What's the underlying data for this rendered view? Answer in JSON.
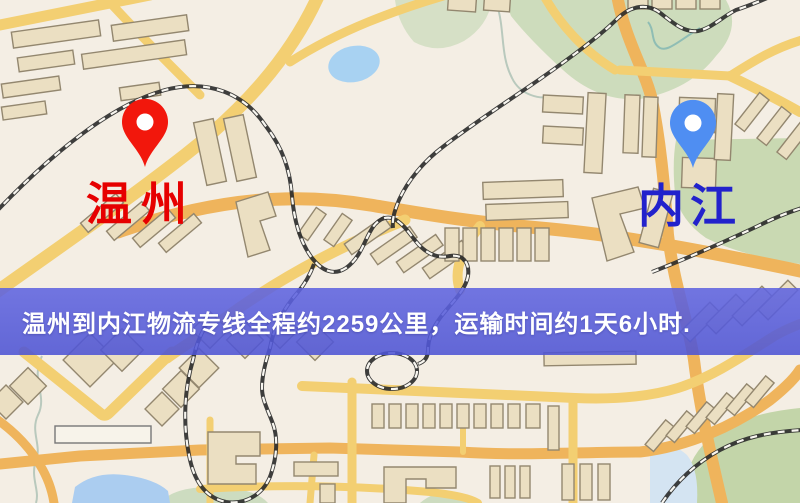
{
  "banner": {
    "text": "温州到内江物流专线全程约2259公里，运输时间约1天6小时."
  },
  "route_info": {
    "origin": "温州",
    "destination": "内江",
    "distance": "约2259公里",
    "duration": "约1天6小时"
  },
  "markers": {
    "origin": {
      "label": "温州",
      "label_color": "#e60000",
      "pin_color": "#f2170c"
    },
    "destination": {
      "label": "内江",
      "label_color": "#2222cc",
      "pin_color": "#4f8ef2"
    }
  },
  "map_colors": {
    "background": "#f4eee4",
    "road_yellow": "#f3cf72",
    "road_orange": "#efb45c",
    "building_fill": "#ebdfc2",
    "building_stroke": "#93876f",
    "park_green": "#cddcbc",
    "water_blue": "#a8d2f2",
    "railway_dark": "#2a2a2a",
    "banner_blue": "#5a60dc"
  }
}
